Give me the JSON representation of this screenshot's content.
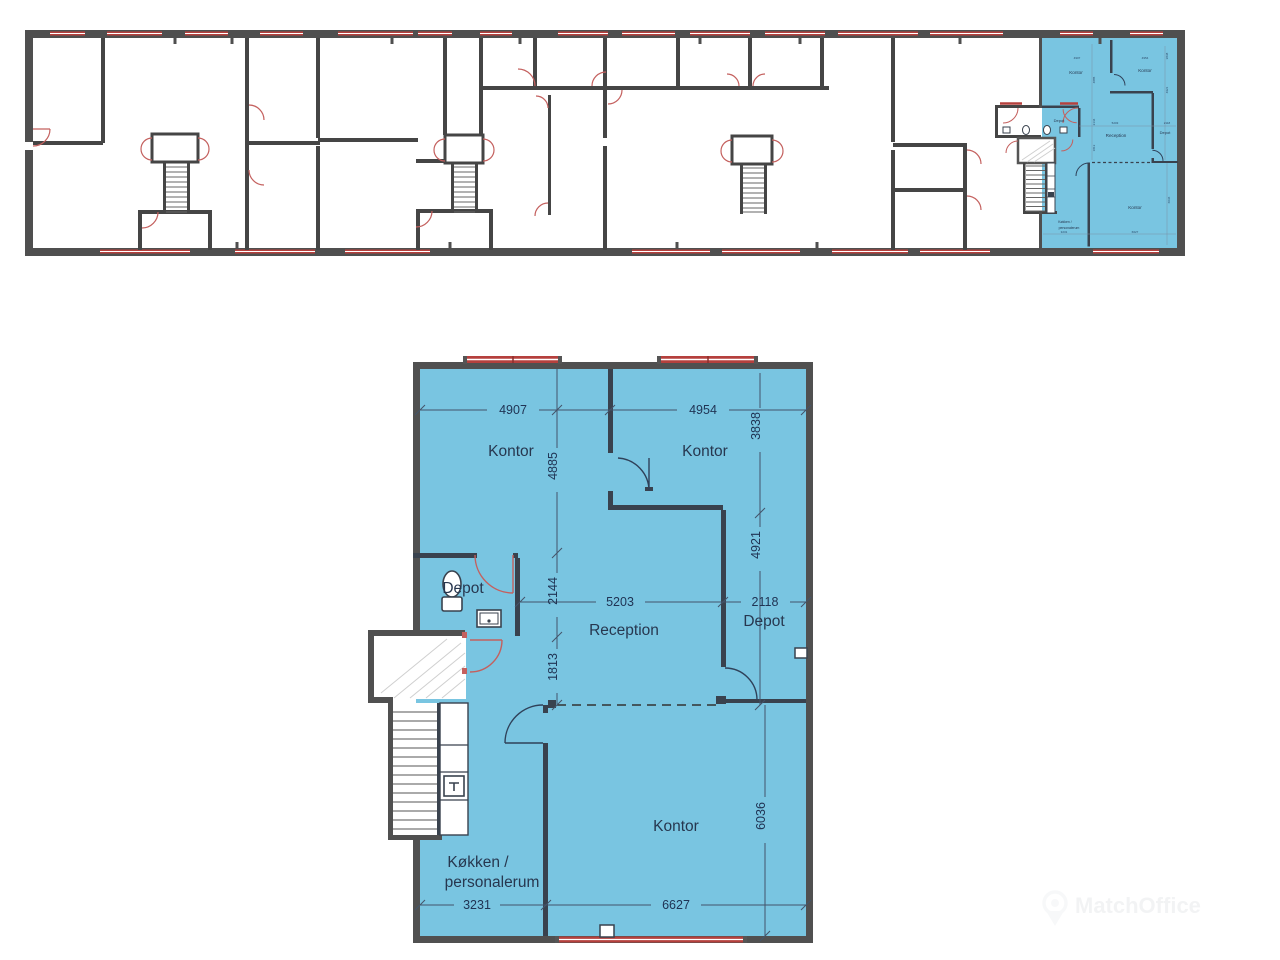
{
  "floorplan": {
    "type": "building-floor-plan",
    "language": "da",
    "highlight_color": "#79c5e1",
    "wall_color": "#4f4f4f",
    "interior_wall_color": "#39424e",
    "window_color": "#b5403d",
    "door_red": "#c4605e",
    "door_navy": "#2f4159",
    "rooms": {
      "kontor_top_left": "Kontor",
      "kontor_top_right": "Kontor",
      "depot_left": "Depot",
      "reception": "Reception",
      "depot_right": "Depot",
      "kontor_bottom": "Kontor",
      "kitchen_line1": "Køkken /",
      "kitchen_line2": "personalerum"
    },
    "dimensions_mm": {
      "kontor_top_left_width": "4907",
      "kontor_top_right_width": "4954",
      "kontor_top_left_height": "4885",
      "kontor_top_right_height": "3838",
      "depot_left_height": "2144",
      "hall_height": "1813",
      "reception_width": "5203",
      "depot_right_width": "2118",
      "depot_right_height": "4921",
      "kitchen_width": "3231",
      "kontor_bottom_width": "6627",
      "kontor_bottom_height": "6036"
    }
  },
  "watermark": {
    "text": "MatchOffice"
  }
}
